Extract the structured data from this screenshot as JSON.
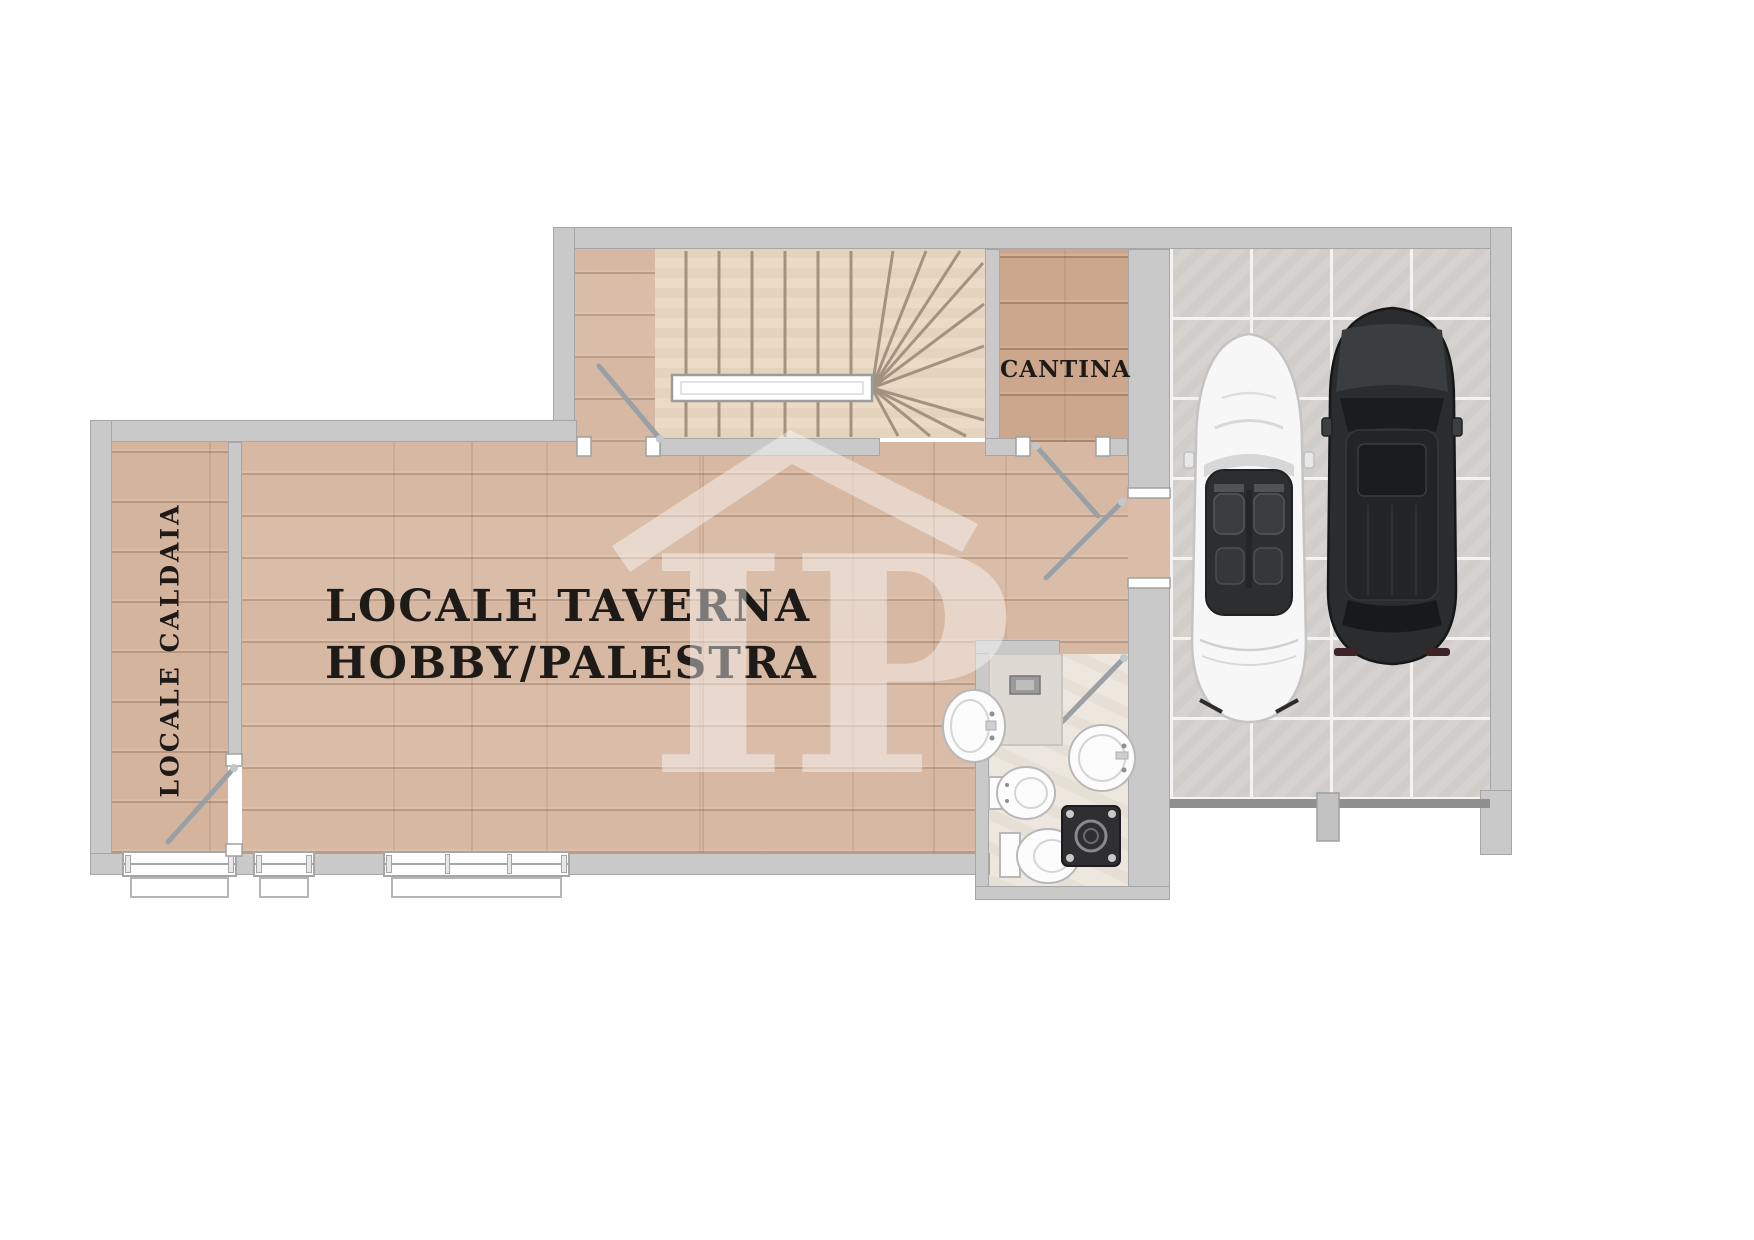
{
  "plan_title": "basement floor plan",
  "rooms": {
    "taverna": {
      "label_line1": "LOCALE TAVERNA",
      "label_line2": "HOBBY/PALESTRA"
    },
    "cantina": {
      "label": "CANTINA"
    },
    "caldaia": {
      "label": "LOCALE CALDAIA"
    }
  },
  "watermark": {
    "letters": "IP"
  },
  "colors": {
    "wall": "#c9c9c9",
    "wall_edge": "#a6a6a6",
    "wood_taverna": "#d9bda9",
    "wood_caldaia": "#d5b49e",
    "wood_cantina": "#cda78d",
    "wood_stairs": "#ebdac5",
    "stair_line": "#a3927f",
    "tile_garage": "#d5d2cf",
    "grout": "#f4f3f1",
    "bath_floor": "#ede7df",
    "shower": "#ded9d2",
    "fixture_fill": "#fcfcfc",
    "fixture_stroke": "#b8b8b8",
    "door": "#9aa1a6",
    "label": "#1d1a17",
    "watermark_color": "#ffffff",
    "car_white": "#f7f7f7",
    "car_black": "#2a2c2e",
    "garage_door": "#8f8f8f"
  }
}
